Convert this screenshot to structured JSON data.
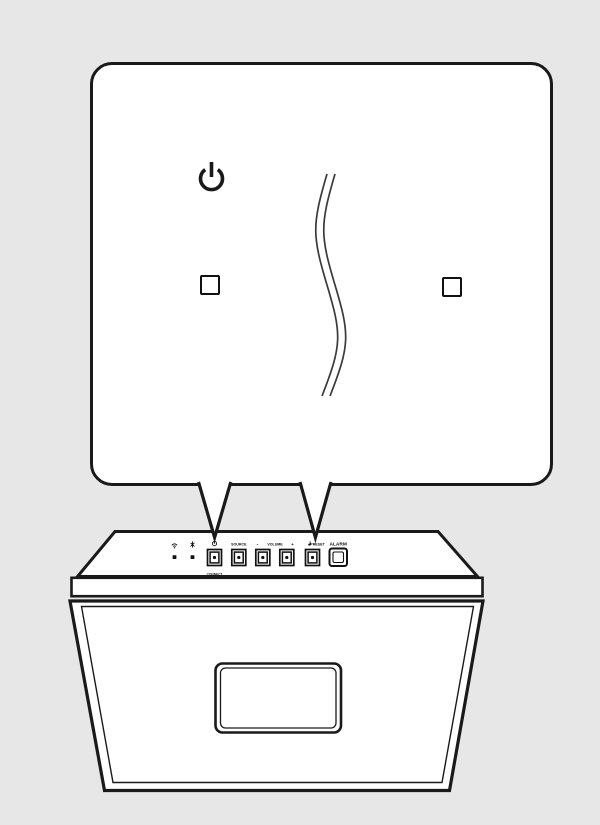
{
  "page": {
    "background_color": "#e7e7e7",
    "line_color": "#1a1a1a",
    "description": "Speaker quick-guide illustration: magnified callout of top-panel power/CONNECT and PRESET buttons"
  },
  "callout": {
    "power_icon": "power-symbol",
    "preset_label": "PRESET",
    "connect_label": "CONNECT",
    "button_fill_color": "#bcbcbc",
    "separator": "wavy-break-mark"
  },
  "device": {
    "indicators": [
      {
        "icon": "wifi-icon"
      },
      {
        "icon": "bluetooth-icon"
      }
    ],
    "panel_labels": {
      "power_icon": "power-symbol",
      "connect": "CONNECT",
      "source": "SOURCE",
      "volume_minus": "-",
      "volume": "VOLUME",
      "volume_plus": "+",
      "preset": "PRESET",
      "alarm": "ALARM"
    }
  }
}
